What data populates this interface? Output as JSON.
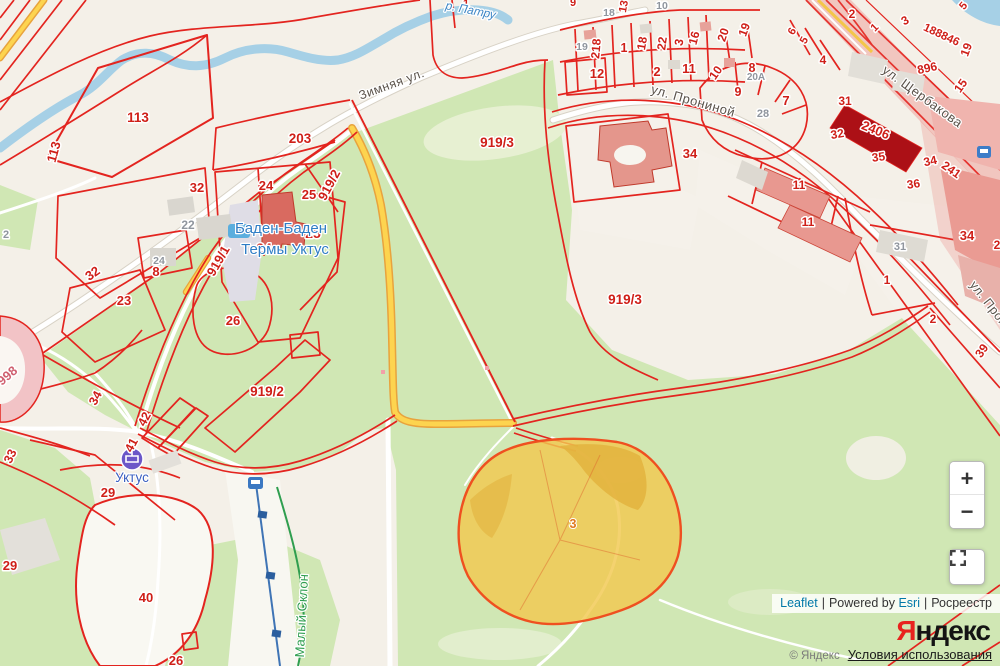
{
  "palette": {
    "land": "#f4f0e8",
    "park_green": "#d0e7b4",
    "water": "#a6d0e6",
    "cadastral_red": "#e3241f",
    "parcel_label_red": "#cf1f18",
    "highlight_road_yellow": "#fdd44f",
    "selected_parcel_fill": "#f1c84f",
    "selected_parcel_border": "#ef5020",
    "building_salmon": "#e4968c",
    "building_dark_red": "#ac1016",
    "link_blue": "#0078A8"
  },
  "map": {
    "labels": [
      {
        "t": "113",
        "x": 138,
        "y": 122,
        "s": 13.5
      },
      {
        "t": "113",
        "x": 58,
        "y": 153,
        "r": -75,
        "s": 13
      },
      {
        "t": "203",
        "x": 300,
        "y": 143,
        "s": 13.5
      },
      {
        "t": "919/2",
        "x": 333,
        "y": 187,
        "r": -62,
        "s": 13
      },
      {
        "t": "919/1",
        "x": 222,
        "y": 263,
        "r": -60,
        "s": 13
      },
      {
        "t": "919/3",
        "x": 497,
        "y": 147,
        "s": 13.5
      },
      {
        "t": "919/3",
        "x": 625,
        "y": 304,
        "s": 13.5
      },
      {
        "t": "919/2",
        "x": 267,
        "y": 396,
        "s": 13.5
      },
      {
        "t": "32",
        "x": 197,
        "y": 192,
        "s": 13
      },
      {
        "t": "24",
        "x": 266,
        "y": 190,
        "s": 13
      },
      {
        "t": "25",
        "x": 309,
        "y": 199,
        "s": 13
      },
      {
        "t": "25",
        "x": 313,
        "y": 238,
        "s": 14
      },
      {
        "t": "24",
        "x": 264,
        "y": 253,
        "s": 14
      },
      {
        "t": "8",
        "x": 156,
        "y": 276,
        "s": 13
      },
      {
        "t": "24",
        "x": 159,
        "y": 264,
        "c": "gray",
        "s": 10.5
      },
      {
        "t": "22",
        "x": 188,
        "y": 229,
        "c": "gray",
        "s": 12
      },
      {
        "t": "32",
        "x": 95,
        "y": 277,
        "r": -35,
        "s": 13
      },
      {
        "t": "23",
        "x": 124,
        "y": 305,
        "s": 13
      },
      {
        "t": "26",
        "x": 233,
        "y": 325,
        "s": 13
      },
      {
        "t": "998",
        "x": 10,
        "y": 379,
        "r": -40,
        "c": "pink",
        "s": 13
      },
      {
        "t": "34",
        "x": 99,
        "y": 400,
        "r": -62,
        "s": 12.5
      },
      {
        "t": "33",
        "x": 14,
        "y": 458,
        "r": -65,
        "s": 12.5
      },
      {
        "t": "42",
        "x": 148,
        "y": 421,
        "r": -62,
        "s": 12.5
      },
      {
        "t": "41",
        "x": 135,
        "y": 447,
        "r": -62,
        "s": 12.5
      },
      {
        "t": "29",
        "x": 108,
        "y": 497,
        "s": 13
      },
      {
        "t": "29",
        "x": 10,
        "y": 570,
        "s": 13
      },
      {
        "t": "40",
        "x": 146,
        "y": 602,
        "s": 13
      },
      {
        "t": "26",
        "x": 176,
        "y": 665,
        "s": 13
      },
      {
        "t": "3",
        "x": 573,
        "y": 528,
        "c": "orange",
        "s": 12.5
      },
      {
        "t": "1",
        "x": 466,
        "y": 7,
        "s": 11
      },
      {
        "t": "9",
        "x": 573,
        "y": 6,
        "s": 11
      },
      {
        "t": "13",
        "x": 627,
        "y": 7,
        "r": -80,
        "s": 11
      },
      {
        "t": "18",
        "x": 609,
        "y": 16,
        "c": "gray",
        "s": 10.5
      },
      {
        "t": "10",
        "x": 662,
        "y": 9,
        "c": "gray",
        "s": 10.5
      },
      {
        "t": "19",
        "x": 582,
        "y": 50,
        "c": "gray",
        "s": 10.5
      },
      {
        "t": "218",
        "x": 600,
        "y": 49,
        "r": -85,
        "s": 12
      },
      {
        "t": "1",
        "x": 624,
        "y": 52,
        "s": 12.5
      },
      {
        "t": "18",
        "x": 646,
        "y": 44,
        "r": -80,
        "s": 12
      },
      {
        "t": "22",
        "x": 666,
        "y": 44,
        "r": -82,
        "s": 12
      },
      {
        "t": "3",
        "x": 683,
        "y": 43,
        "r": -80,
        "s": 12
      },
      {
        "t": "16",
        "x": 698,
        "y": 39,
        "r": -75,
        "s": 12
      },
      {
        "t": "20",
        "x": 727,
        "y": 36,
        "r": -72,
        "s": 12
      },
      {
        "t": "19",
        "x": 748,
        "y": 31,
        "r": -70,
        "s": 12
      },
      {
        "t": "12",
        "x": 597,
        "y": 78,
        "s": 13
      },
      {
        "t": "2",
        "x": 657,
        "y": 76,
        "s": 13
      },
      {
        "t": "11",
        "x": 689,
        "y": 73,
        "s": 13
      },
      {
        "t": "10",
        "x": 719,
        "y": 75,
        "r": -55,
        "s": 12
      },
      {
        "t": "8",
        "x": 752,
        "y": 72,
        "s": 12.5
      },
      {
        "t": "9",
        "x": 738,
        "y": 96,
        "s": 12.5
      },
      {
        "t": "7",
        "x": 786,
        "y": 105,
        "s": 13
      },
      {
        "t": "28",
        "x": 763,
        "y": 117,
        "c": "gray",
        "s": 11
      },
      {
        "t": "20А",
        "x": 756,
        "y": 80,
        "c": "gray",
        "s": 10
      },
      {
        "t": "6",
        "x": 795,
        "y": 33,
        "r": -60,
        "s": 11
      },
      {
        "t": "5",
        "x": 807,
        "y": 42,
        "r": -60,
        "s": 11
      },
      {
        "t": "4",
        "x": 823,
        "y": 64,
        "s": 12
      },
      {
        "t": "2",
        "x": 852,
        "y": 18,
        "s": 12
      },
      {
        "t": "1",
        "x": 877,
        "y": 30,
        "r": -45,
        "s": 11
      },
      {
        "t": "3",
        "x": 907,
        "y": 24,
        "r": -30,
        "s": 12
      },
      {
        "t": "188846",
        "x": 940,
        "y": 38,
        "r": 25,
        "s": 11.5
      },
      {
        "t": "19",
        "x": 970,
        "y": 51,
        "r": -70,
        "s": 12
      },
      {
        "t": "5",
        "x": 966,
        "y": 8,
        "r": -50,
        "s": 11
      },
      {
        "t": "896",
        "x": 928,
        "y": 72,
        "r": -12,
        "s": 12
      },
      {
        "t": "15",
        "x": 964,
        "y": 88,
        "r": -55,
        "s": 12
      },
      {
        "t": "31",
        "x": 845,
        "y": 105,
        "s": 12
      },
      {
        "t": "2406",
        "x": 874,
        "y": 134,
        "r": 22,
        "s": 13
      },
      {
        "t": "32",
        "x": 838,
        "y": 138,
        "r": -10,
        "s": 12
      },
      {
        "t": "35",
        "x": 879,
        "y": 161,
        "r": -8,
        "s": 12
      },
      {
        "t": "36",
        "x": 914,
        "y": 188,
        "r": -8,
        "s": 12
      },
      {
        "t": "34",
        "x": 931,
        "y": 165,
        "r": -12,
        "s": 12
      },
      {
        "t": "241",
        "x": 949,
        "y": 173,
        "r": 35,
        "s": 12
      },
      {
        "t": "34",
        "x": 967,
        "y": 240,
        "s": 13
      },
      {
        "t": "2",
        "x": 997,
        "y": 249,
        "s": 12
      },
      {
        "t": "11",
        "x": 799,
        "y": 189,
        "s": 12
      },
      {
        "t": "11",
        "x": 808,
        "y": 226,
        "s": 12
      },
      {
        "t": "31",
        "x": 900,
        "y": 250,
        "c": "gray",
        "s": 11
      },
      {
        "t": "1",
        "x": 887,
        "y": 284,
        "s": 12
      },
      {
        "t": "2",
        "x": 933,
        "y": 323,
        "s": 12
      },
      {
        "t": "39",
        "x": 985,
        "y": 353,
        "r": -55,
        "s": 12
      },
      {
        "t": "34",
        "x": 690,
        "y": 158,
        "s": 13
      },
      {
        "t": "2",
        "x": 6,
        "y": 238,
        "c": "gray",
        "s": 11
      },
      {
        "t": "Зимняя ул.",
        "x": 393,
        "y": 88,
        "r": -20,
        "c": "street",
        "s": 12.5
      },
      {
        "t": "ул. Прониной",
        "x": 692,
        "y": 105,
        "r": 16,
        "c": "street",
        "s": 13
      },
      {
        "t": "ул. Щербакова",
        "x": 920,
        "y": 100,
        "r": 36,
        "c": "street",
        "s": 13
      },
      {
        "t": "ул. Прониной",
        "x": 995,
        "y": 318,
        "r": 52,
        "c": "street",
        "s": 12.5
      },
      {
        "t": "р. Патру",
        "x": 470,
        "y": 14,
        "r": 11,
        "c": "river",
        "s": 12
      },
      {
        "t": "Баден-Баден",
        "x": 281,
        "y": 233,
        "c": "poi",
        "s": 15
      },
      {
        "t": "Термы Уктус",
        "x": 285,
        "y": 254,
        "c": "poi",
        "s": 15
      },
      {
        "t": "Уктус",
        "x": 132,
        "y": 482,
        "c": "poi2",
        "s": 13.5
      },
      {
        "t": "Малый Склон",
        "x": 306,
        "y": 616,
        "r": -87,
        "c": "greenl",
        "s": 13
      }
    ]
  },
  "ui": {
    "controls": {
      "zoom_in": "+",
      "zoom_out": "−"
    },
    "attribution": {
      "leaflet": "Leaflet",
      "sep": "|",
      "powered": "Powered by",
      "esri": "Esri",
      "rosreestr": "Росреестр"
    },
    "yandex": {
      "logo_first": "Я",
      "logo_rest": "ндекс",
      "copyright": "© Яндекс",
      "terms": "Условия использования"
    }
  }
}
